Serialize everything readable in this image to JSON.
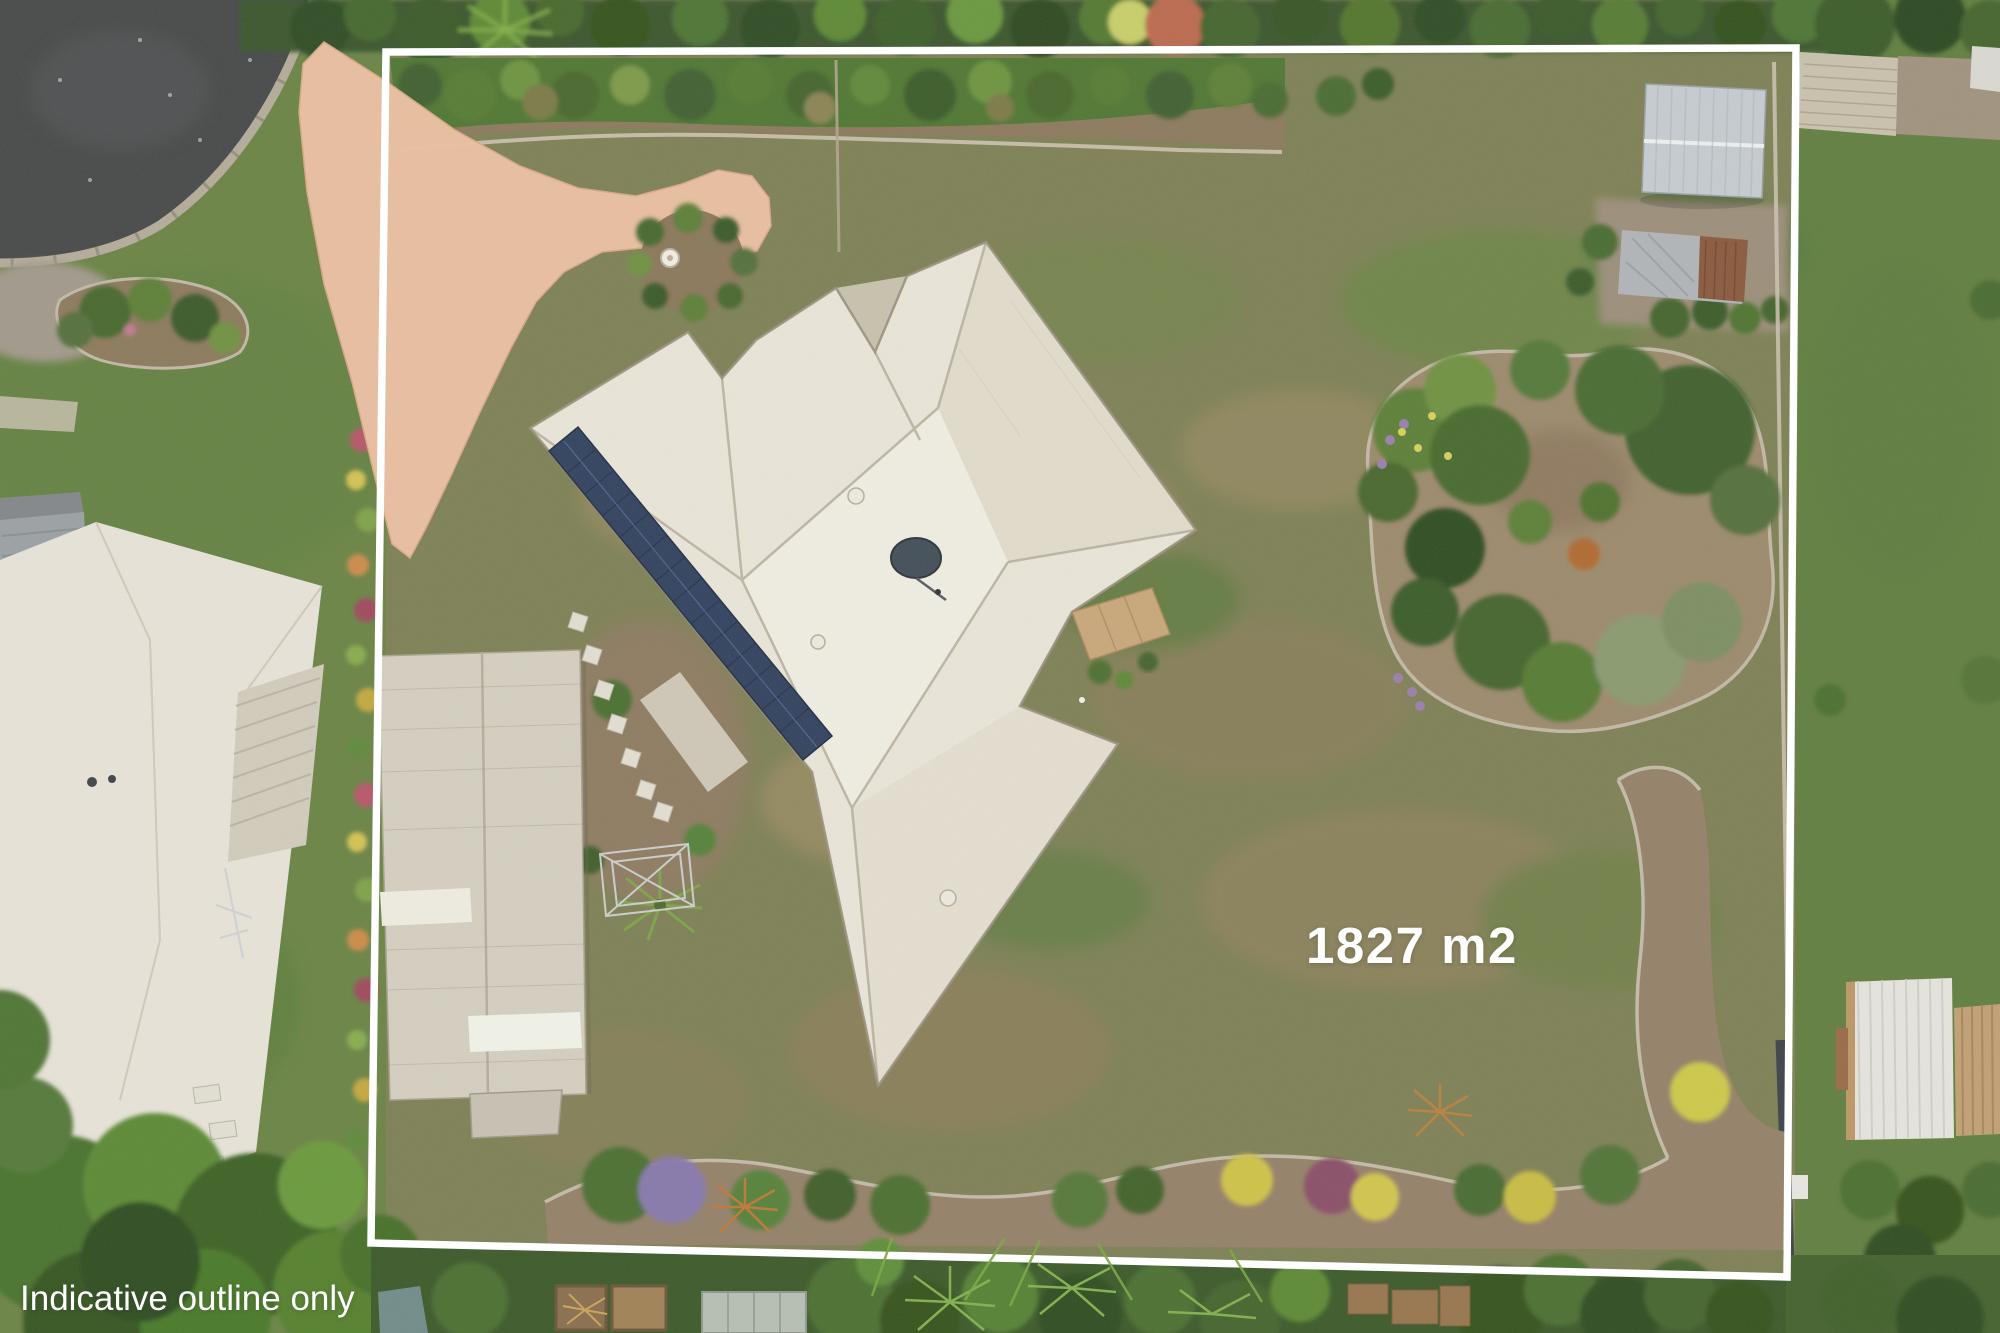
{
  "scene": {
    "type": "aerial-drone-photograph",
    "description": "Top-down aerial real-estate photo of a large residential block with a white indicative boundary outline drawn over it"
  },
  "overlays": {
    "area_label": "1827 m2",
    "disclaimer": "Indicative outline only"
  },
  "colors": {
    "boundary_outline": "#ffffff",
    "overlay_text": "#ffffff",
    "lawn_base": "#7e8156",
    "driveway": "#edc1a3",
    "house_roof": "#eae6da",
    "solar_panels": "#32425f",
    "road_asphalt": "#47494a"
  }
}
